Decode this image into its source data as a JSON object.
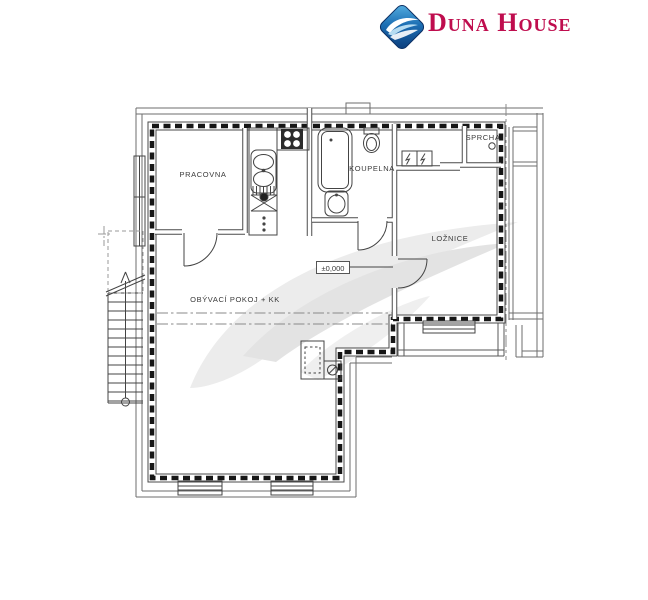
{
  "brand": {
    "name": "Duna House",
    "icon": "wave-diamond-logo",
    "accent_color": "#bf0d4e",
    "diamond_blue": "#1d6fb4"
  },
  "floor_plan": {
    "rooms": [
      {
        "id": "pracovna",
        "label": "PRACOVNA"
      },
      {
        "id": "koupelna",
        "label": "KOUPELNA"
      },
      {
        "id": "sprcha",
        "label": "SPRCHA"
      },
      {
        "id": "loznice",
        "label": "LOŽNICE"
      },
      {
        "id": "obyvaci_pokoj_kk",
        "label": "OBÝVACÍ POKOJ + KK"
      }
    ],
    "level_marker": "±0,000",
    "fixtures": [
      "staircase",
      "kitchen-sink",
      "stove",
      "bathtub",
      "toilet",
      "washbasin",
      "fireplace",
      "shower-drain",
      "electrical-meters",
      "windows",
      "doors"
    ],
    "line_colors": {
      "walls": "#4a4a4a",
      "insulated_wall_dashes": "#161616",
      "boundary_dash_dot": "#888888",
      "watermark": "#ebebeb"
    }
  }
}
